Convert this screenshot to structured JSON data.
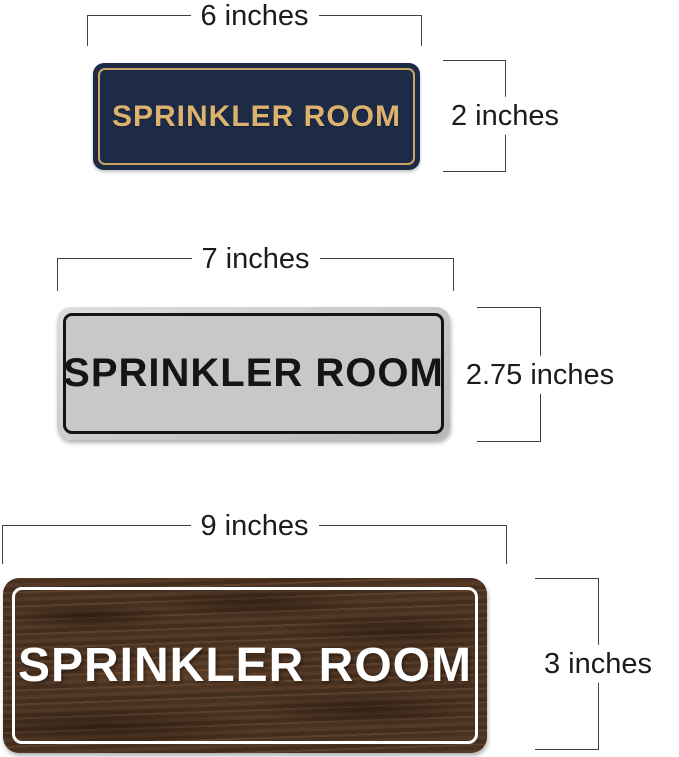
{
  "dimension_color": "#3f3f3f",
  "signs": [
    {
      "variant": "navy-gold",
      "name": "SPRINKLER ROOM",
      "width_label": "6 inches",
      "height_label": "2 inches",
      "colors": {
        "background": "#1e2b47",
        "border": "#c9a566",
        "text": "#dcb26f"
      }
    },
    {
      "variant": "silver-black",
      "name": "SPRINKLER ROOM",
      "width_label": "7 inches",
      "height_label": "2.75 inches",
      "colors": {
        "background": "#c8c8ca",
        "border": "#141414",
        "text": "#151515"
      }
    },
    {
      "variant": "wood-white",
      "name": "SPRINKLER ROOM",
      "width_label": "9 inches",
      "height_label": "3 inches",
      "colors": {
        "background": "#4f3624",
        "border": "#ffffff",
        "text": "#ffffff"
      }
    }
  ]
}
